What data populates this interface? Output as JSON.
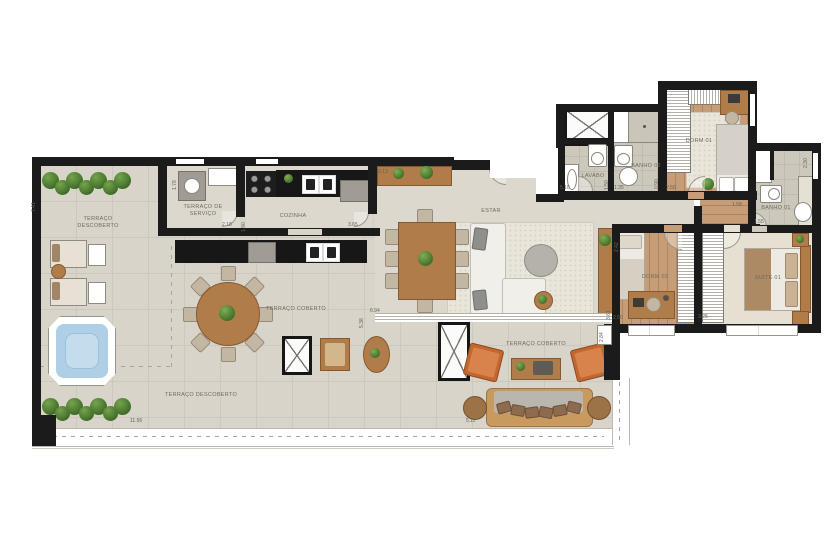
{
  "floorplan": {
    "rooms": {
      "terraco_descoberto_top": "TERRAÇO\nDESCOBERTO",
      "terraco_servico": "TERRAÇO DE\nSERVIÇO",
      "cozinha": "COZINHA",
      "estar": "ESTAR",
      "lavabo": "LAVABO",
      "banho02": "BANHO 02",
      "dorm01": "DORM 01",
      "banho01": "BANHO 01",
      "dorm02": "DORM 02",
      "suite01": "SUÍTE 01",
      "terraco_coberto_left": "TERRAÇO COBERTO",
      "terraco_coberto_right": "TERRAÇO COBERTO",
      "terraco_descoberto_bottom": "TERRAÇO DESCOBERTO"
    },
    "dimensions": {
      "terrace_left_height": "7.41",
      "servico_depth": "1.78",
      "servico_width": "2.18",
      "cozinha_depth": "1.90",
      "cozinha_width": "3.65",
      "sideboard_width": "3.13",
      "estar_height": "5.38",
      "estar_width": "6.94",
      "lavabo_width": "5.10",
      "lavabo_height": "1.50",
      "banho02_width": "1.35",
      "dorm01_closet_depth": "0.90",
      "dorm01_width": "2.50",
      "hall_width": "1.58",
      "banho01_height": "2.30",
      "banho01_width": "1.55",
      "console_height": "2.42",
      "dorm02_height": "3.61",
      "dorm02_width": "2.50",
      "suite_width": "3.25",
      "terrace_notch_height": "2.84",
      "terrace_bottom_width": "11.56",
      "sofa_width": "5.11"
    },
    "colors": {
      "wall": "#1b1b1b",
      "terrace_floor": "#d8d4c9",
      "wood_floor": "#c69d76",
      "hot_tub_water": "#aecfe5",
      "hedge_green": "#4c7a31",
      "armchair_orange": "#c2672f",
      "furniture_wood": "#b07c4a"
    }
  }
}
